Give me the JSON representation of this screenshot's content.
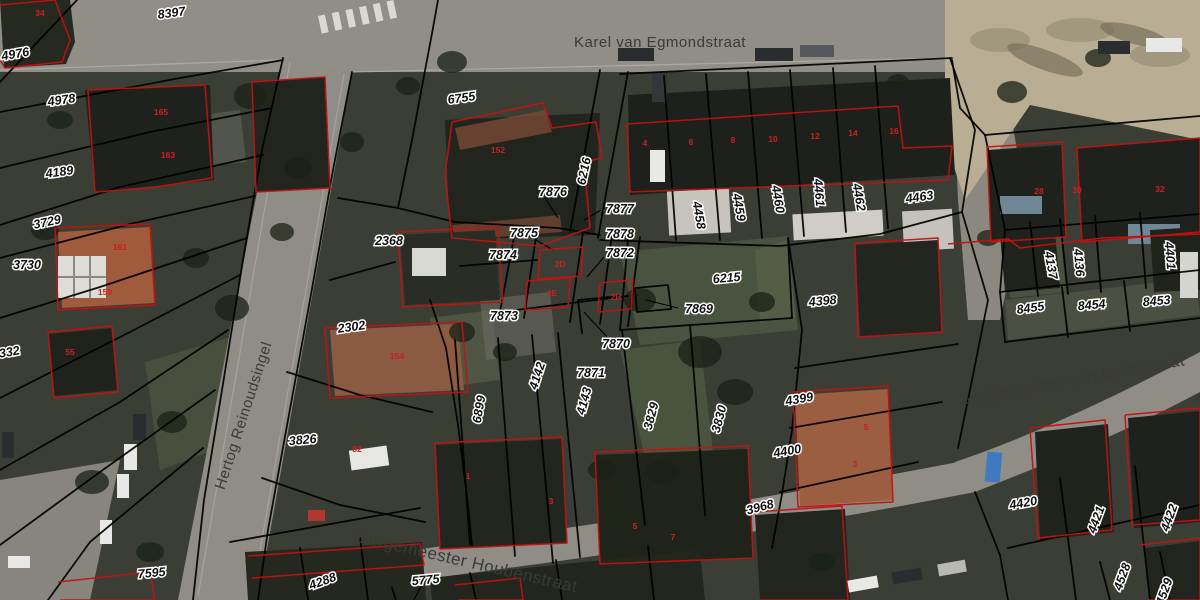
{
  "map": {
    "colors": {
      "background": "#3b3e35",
      "road": "#908e86",
      "sand_path": "#b9ad93",
      "parcel_line": "#000000",
      "building_outline": "#c41111",
      "parcel_label_fill": "#101010",
      "parcel_label_halo": "#ffffff",
      "street_label": "#3a3a36",
      "house_number": "#cc2020"
    },
    "street_labels": [
      {
        "text": "Karel van Egmondstraat",
        "x": 660,
        "y": 47,
        "rotation": 0,
        "size": 15
      },
      {
        "text": "Hertog Reinoudsingel",
        "x": 248,
        "y": 417,
        "rotation": -72,
        "size": 15
      },
      {
        "text": "Burgemeester van Darthstraat",
        "x": 1073,
        "y": 385,
        "rotation": -10,
        "size": 16
      },
      {
        "text": "Burgemeester Houbenstraat",
        "x": 466,
        "y": 567,
        "rotation": 13,
        "size": 17
      }
    ],
    "parcel_labels": [
      {
        "text": "8397",
        "x": 172,
        "y": 17,
        "rotation": -8
      },
      {
        "text": "4976",
        "x": 16,
        "y": 58,
        "rotation": -10
      },
      {
        "text": "4978",
        "x": 62,
        "y": 104,
        "rotation": -8
      },
      {
        "text": "4189",
        "x": 60,
        "y": 176,
        "rotation": -8
      },
      {
        "text": "3729",
        "x": 48,
        "y": 226,
        "rotation": -12
      },
      {
        "text": "3730",
        "x": 27,
        "y": 269,
        "rotation": 0
      },
      {
        "text": "332",
        "x": 10,
        "y": 356,
        "rotation": -10
      },
      {
        "text": "7595",
        "x": 152,
        "y": 577,
        "rotation": -5
      },
      {
        "text": "6755",
        "x": 462,
        "y": 102,
        "rotation": -8
      },
      {
        "text": "2368",
        "x": 389,
        "y": 245,
        "rotation": 0
      },
      {
        "text": "2302",
        "x": 352,
        "y": 331,
        "rotation": -8
      },
      {
        "text": "3826",
        "x": 303,
        "y": 444,
        "rotation": -5
      },
      {
        "text": "7876",
        "x": 553,
        "y": 196,
        "rotation": 0
      },
      {
        "text": "6216",
        "x": 588,
        "y": 172,
        "rotation": -78
      },
      {
        "text": "7877",
        "x": 620,
        "y": 213,
        "rotation": 0
      },
      {
        "text": "7875",
        "x": 524,
        "y": 237,
        "rotation": 0
      },
      {
        "text": "7878",
        "x": 620,
        "y": 238,
        "rotation": 0
      },
      {
        "text": "7874",
        "x": 503,
        "y": 259,
        "rotation": 0
      },
      {
        "text": "7872",
        "x": 620,
        "y": 257,
        "rotation": 0
      },
      {
        "text": "7873",
        "x": 504,
        "y": 320,
        "rotation": 0
      },
      {
        "text": "7869",
        "x": 699,
        "y": 313,
        "rotation": 0
      },
      {
        "text": "6215",
        "x": 727,
        "y": 282,
        "rotation": -5
      },
      {
        "text": "7870",
        "x": 616,
        "y": 348,
        "rotation": 0
      },
      {
        "text": "7871",
        "x": 591,
        "y": 377,
        "rotation": 0
      },
      {
        "text": "4142",
        "x": 541,
        "y": 377,
        "rotation": -72
      },
      {
        "text": "4143",
        "x": 588,
        "y": 402,
        "rotation": -75
      },
      {
        "text": "6899",
        "x": 483,
        "y": 410,
        "rotation": -80
      },
      {
        "text": "3829",
        "x": 655,
        "y": 417,
        "rotation": -75
      },
      {
        "text": "3830",
        "x": 723,
        "y": 420,
        "rotation": -75
      },
      {
        "text": "4458",
        "x": 695,
        "y": 216,
        "rotation": 80
      },
      {
        "text": "4459",
        "x": 735,
        "y": 208,
        "rotation": 80
      },
      {
        "text": "4460",
        "x": 774,
        "y": 200,
        "rotation": 80
      },
      {
        "text": "4461",
        "x": 815,
        "y": 193,
        "rotation": 85
      },
      {
        "text": "4462",
        "x": 855,
        "y": 198,
        "rotation": 80
      },
      {
        "text": "4463",
        "x": 920,
        "y": 201,
        "rotation": -8
      },
      {
        "text": "4398",
        "x": 823,
        "y": 305,
        "rotation": -5
      },
      {
        "text": "4399",
        "x": 800,
        "y": 403,
        "rotation": -10
      },
      {
        "text": "4400",
        "x": 788,
        "y": 455,
        "rotation": -10
      },
      {
        "text": "3968",
        "x": 761,
        "y": 511,
        "rotation": -15
      },
      {
        "text": "4137",
        "x": 1047,
        "y": 266,
        "rotation": 80
      },
      {
        "text": "4136",
        "x": 1075,
        "y": 263,
        "rotation": 85
      },
      {
        "text": "4401",
        "x": 1166,
        "y": 256,
        "rotation": 85
      },
      {
        "text": "8455",
        "x": 1031,
        "y": 312,
        "rotation": -8
      },
      {
        "text": "8454",
        "x": 1092,
        "y": 309,
        "rotation": -5
      },
      {
        "text": "8453",
        "x": 1157,
        "y": 305,
        "rotation": -5
      },
      {
        "text": "4420",
        "x": 1024,
        "y": 507,
        "rotation": -10
      },
      {
        "text": "4421",
        "x": 1100,
        "y": 521,
        "rotation": -70
      },
      {
        "text": "4422",
        "x": 1173,
        "y": 519,
        "rotation": -70
      },
      {
        "text": "4528",
        "x": 1126,
        "y": 578,
        "rotation": -70
      },
      {
        "text": "4529",
        "x": 1168,
        "y": 593,
        "rotation": -70
      },
      {
        "text": "4288",
        "x": 324,
        "y": 585,
        "rotation": -20
      },
      {
        "text": "5775",
        "x": 426,
        "y": 584,
        "rotation": -5
      }
    ],
    "house_numbers": [
      {
        "text": "34",
        "x": 40,
        "y": 16
      },
      {
        "text": "165",
        "x": 161,
        "y": 115
      },
      {
        "text": "163",
        "x": 168,
        "y": 158
      },
      {
        "text": "161",
        "x": 120,
        "y": 250
      },
      {
        "text": "159",
        "x": 105,
        "y": 295
      },
      {
        "text": "55",
        "x": 70,
        "y": 355
      },
      {
        "text": "152",
        "x": 498,
        "y": 153
      },
      {
        "text": "154",
        "x": 397,
        "y": 359
      },
      {
        "text": "82",
        "x": 357,
        "y": 452
      },
      {
        "text": "1",
        "x": 468,
        "y": 479
      },
      {
        "text": "3",
        "x": 551,
        "y": 504
      },
      {
        "text": "5",
        "x": 635,
        "y": 529
      },
      {
        "text": "7",
        "x": 673,
        "y": 540
      },
      {
        "text": "5",
        "x": 866,
        "y": 430
      },
      {
        "text": "3",
        "x": 855,
        "y": 467
      },
      {
        "text": "4",
        "x": 645,
        "y": 146
      },
      {
        "text": "6",
        "x": 691,
        "y": 145
      },
      {
        "text": "8",
        "x": 733,
        "y": 143
      },
      {
        "text": "10",
        "x": 773,
        "y": 142
      },
      {
        "text": "12",
        "x": 815,
        "y": 139
      },
      {
        "text": "14",
        "x": 853,
        "y": 136
      },
      {
        "text": "16",
        "x": 894,
        "y": 134
      },
      {
        "text": "28",
        "x": 1039,
        "y": 194
      },
      {
        "text": "30",
        "x": 1077,
        "y": 193
      },
      {
        "text": "32",
        "x": 1160,
        "y": 192
      },
      {
        "text": "2D",
        "x": 560,
        "y": 267
      },
      {
        "text": "2E",
        "x": 552,
        "y": 296
      },
      {
        "text": "2H",
        "x": 616,
        "y": 300
      }
    ]
  }
}
